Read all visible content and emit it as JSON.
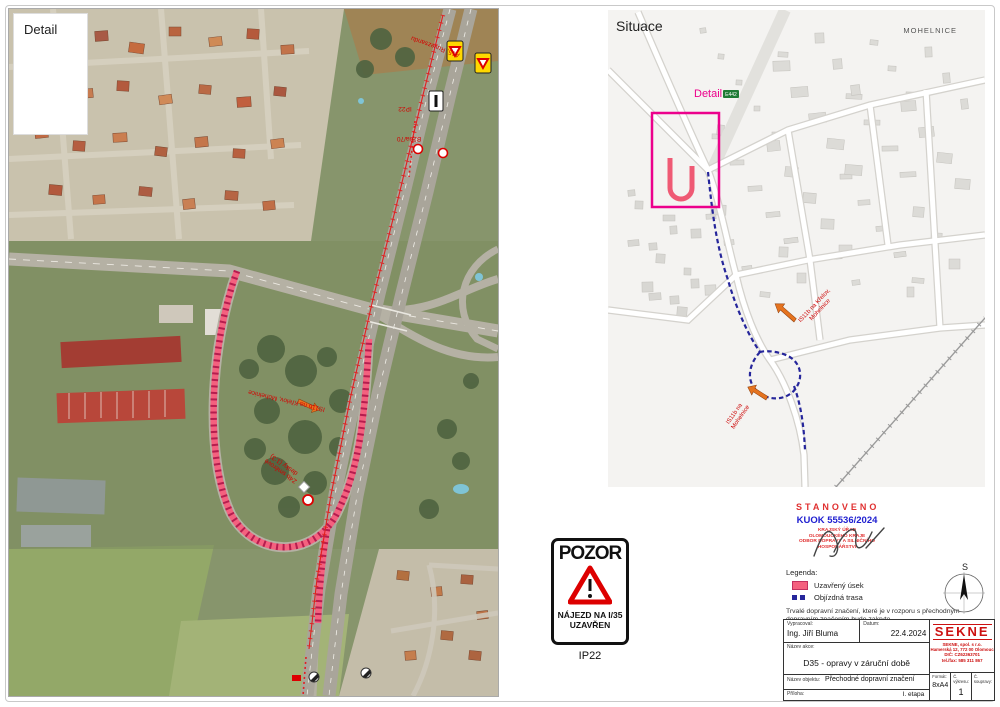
{
  "detail_panel": {
    "label": "Detail",
    "annotations": {
      "a15": "A15, Ruvezsandu",
      "ip22": "IP22",
      "b20a": "B20a/70",
      "loop": "IS11b na Křelov, Mohelnice",
      "boards_line1": "Z4b směrové",
      "boards_line2": "desky (1:3)"
    }
  },
  "situace_panel": {
    "label": "Situace",
    "city": "MOHELNICE",
    "detail_label": "Detail",
    "road_badge": "E442",
    "annotations": {
      "is11b_a_line1": "IS11b na Křelov,",
      "is11b_a_line2": "Mohelnice",
      "is11b_b_line1": "IS11b na",
      "is11b_b_line2": "Mohelnice"
    }
  },
  "sign_ip22": {
    "title": "POZOR",
    "line1": "NÁJEZD NA I/35",
    "line2": "UZAVŘEN",
    "code": "IP22"
  },
  "stamp": {
    "title": "STANOVENO",
    "number": "KUOK 55536/2024",
    "office_line1": "KRAJSKÝ ÚŘAD",
    "office_line2": "OLOMOUCKÉHO KRAJE",
    "office_line3": "ODBOR DOPRAVY A SILNIČNÍHO",
    "office_line4": "HOSPODÁŘSTVÍ"
  },
  "legend": {
    "title": "Legenda:",
    "closed": "Uzavřený úsek",
    "detour": "Objízdná trasa",
    "note": "Trvalé dopravní značení, které je v rozporu s přechodným dopravním značením bude zakryto."
  },
  "compass": {
    "north": "S"
  },
  "titleblock": {
    "vypracoval_label": "Vypracoval:",
    "vypracoval": "Ing. Jiří Bluma",
    "datum_label": "Datum:",
    "datum": "22.4.2024",
    "nazev_akce_label": "Název akce:",
    "nazev_akce": "D35 - opravy v záruční době",
    "nazev_objektu_label": "Název objektu:",
    "nazev_objektu": "Přechodné dopravní značení",
    "priloha_label": "Příloha:",
    "priloha": "I. etapa",
    "format_label": "Formát:",
    "format": "8xA4",
    "vykres_label": "Č. výkresu:",
    "vykres": "1",
    "souprava_label": "Č. soupravy:",
    "souprava": "",
    "company": {
      "name": "SEKNE",
      "line1": "SEKNE, spol. s r.o.",
      "line2": "Hamerská 12, 772 00 Olomouc",
      "line3": "DIČ: CZ62363701",
      "line4": "tel./fax: 585 311 867"
    }
  },
  "colors": {
    "closure": "#f4617f",
    "closure_dark": "#b51d4e",
    "detour": "#26269b",
    "magenta": "#ec008c",
    "annotation_red": "#d40000",
    "stamp_red": "#e03030",
    "stamp_blue": "#2020d0"
  }
}
